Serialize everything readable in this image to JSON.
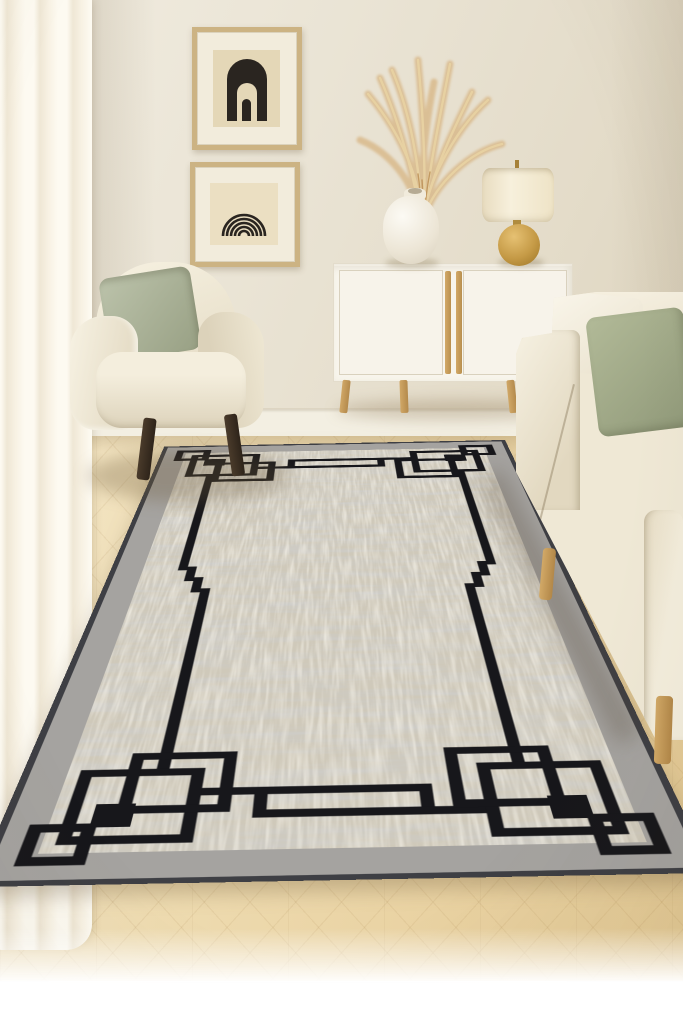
{
  "scene": {
    "type": "interior-photo",
    "room": "living room",
    "style": "minimalist neutral",
    "objects": [
      {
        "id": "wall",
        "label": "Cream plaster wall"
      },
      {
        "id": "curtain",
        "label": "Sheer cream curtain panel"
      },
      {
        "id": "frame-arch",
        "label": "Framed black double-arch print"
      },
      {
        "id": "frame-rainbow",
        "label": "Framed black line rainbow print"
      },
      {
        "id": "armchair",
        "label": "Cream boucle armchair with sage green pillow and dark tapered legs"
      },
      {
        "id": "sideboard",
        "label": "White two-door sideboard with oak handles and splayed oak legs"
      },
      {
        "id": "vase",
        "label": "White ceramic vase with dried pampas grass"
      },
      {
        "id": "lamp",
        "label": "Table lamp with cream drum shade and round gold ceramic base"
      },
      {
        "id": "sofa",
        "label": "Cream fabric sofa with white and sage pillows and oak legs"
      },
      {
        "id": "rug",
        "label": "Gray textured area rug with black geometric fret border and corner motifs"
      },
      {
        "id": "floor",
        "label": "Light oak herringbone parquet floor"
      }
    ]
  },
  "palette": {
    "wall": "#eae4d5",
    "curtain": "#f8f2e4",
    "floor_wood": "#eedbb0",
    "upholstery_cream": "#f1ebdb",
    "pillow_sage": "#aab28f",
    "wood_oak": "#c79e5f",
    "lamp_gold": "#c59a46",
    "rug_field": "#cfc9ba",
    "rug_gray_band": "#a5a3a0",
    "rug_binding": "#3e3f44",
    "rug_pattern_black": "#17171b",
    "art_black": "#2a2520"
  }
}
